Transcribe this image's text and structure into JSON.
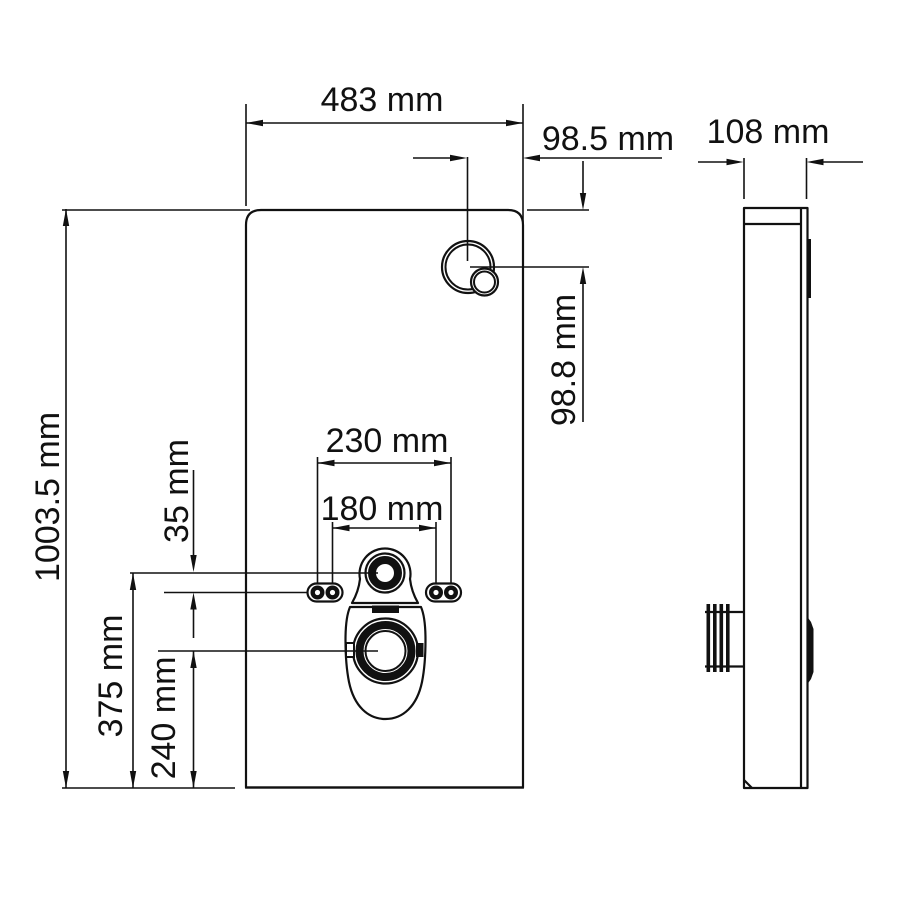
{
  "drawing": {
    "type": "technical-dimension-drawing",
    "subject": "wall-hung sanitary module / cistern panel, front and side views",
    "units": "mm",
    "colors": {
      "line": "#111111",
      "background": "#ffffff"
    }
  },
  "front_view": {
    "dims": {
      "width": "483 mm",
      "height": "1003.5 mm",
      "button_offset_from_right": "98.5 mm",
      "button_offset_from_top": "98.8 mm",
      "holes_outer_spacing": "230 mm",
      "holes_inner_spacing": "180 mm",
      "supply_to_holes_offset": "35 mm",
      "supply_center_height": "375 mm",
      "drain_center_height": "240 mm"
    }
  },
  "side_view": {
    "dims": {
      "depth": "108 mm"
    }
  }
}
